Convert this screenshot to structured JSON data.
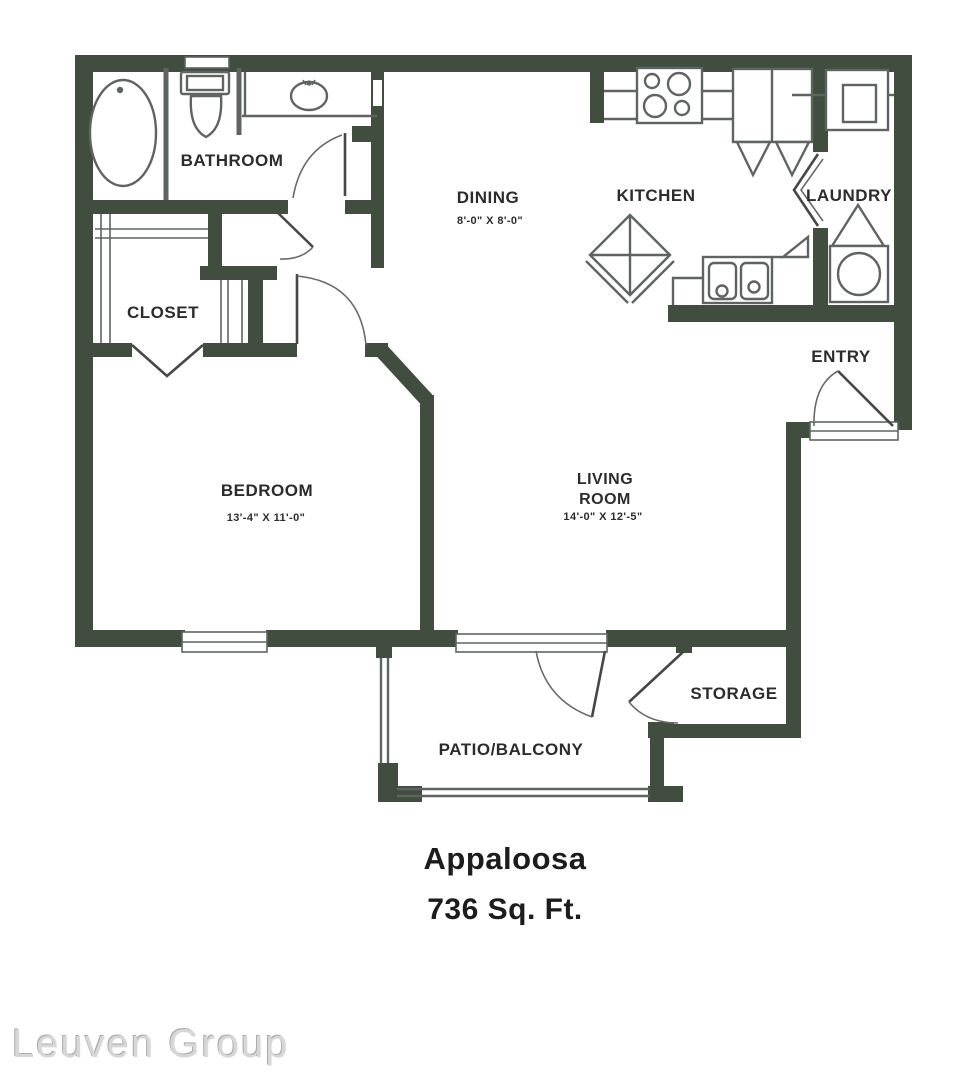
{
  "plan": {
    "rooms": {
      "bathroom": {
        "label": "BATHROOM"
      },
      "closet": {
        "label": "CLOSET"
      },
      "bedroom": {
        "label": "BEDROOM",
        "dimensions": "13'-4\" X 11'-0\""
      },
      "dining": {
        "label": "DINING",
        "dimensions": "8'-0\" X 8'-0\""
      },
      "kitchen": {
        "label": "KITCHEN"
      },
      "laundry": {
        "label": "LAUNDRY"
      },
      "entry": {
        "label": "ENTRY"
      },
      "living_room": {
        "label_line1": "LIVING",
        "label_line2": "ROOM",
        "dimensions": "14'-0\" X 12'-5\""
      },
      "storage": {
        "label": "STORAGE"
      },
      "patio": {
        "label": "PATIO/BALCONY"
      }
    },
    "title": {
      "name": "Appaloosa",
      "area": "736 Sq. Ft."
    },
    "watermark": "Leuven Group",
    "icons": [
      "bathtub-icon",
      "toilet-icon",
      "vanity-sink-icon",
      "stove-icon",
      "refrigerator-icon",
      "dryer-icon",
      "washer-icon",
      "kitchen-island-icon",
      "kitchen-sink-icon",
      "door-swing-icon",
      "bifold-door-icon",
      "window-icon",
      "patio-railing-icon"
    ],
    "colors": {
      "wall": "#414d3f",
      "fixture_line": "#5f6462",
      "label_text": "#2c2c2c",
      "watermark_text": "#d7d7d7",
      "background": "#ffffff"
    }
  }
}
